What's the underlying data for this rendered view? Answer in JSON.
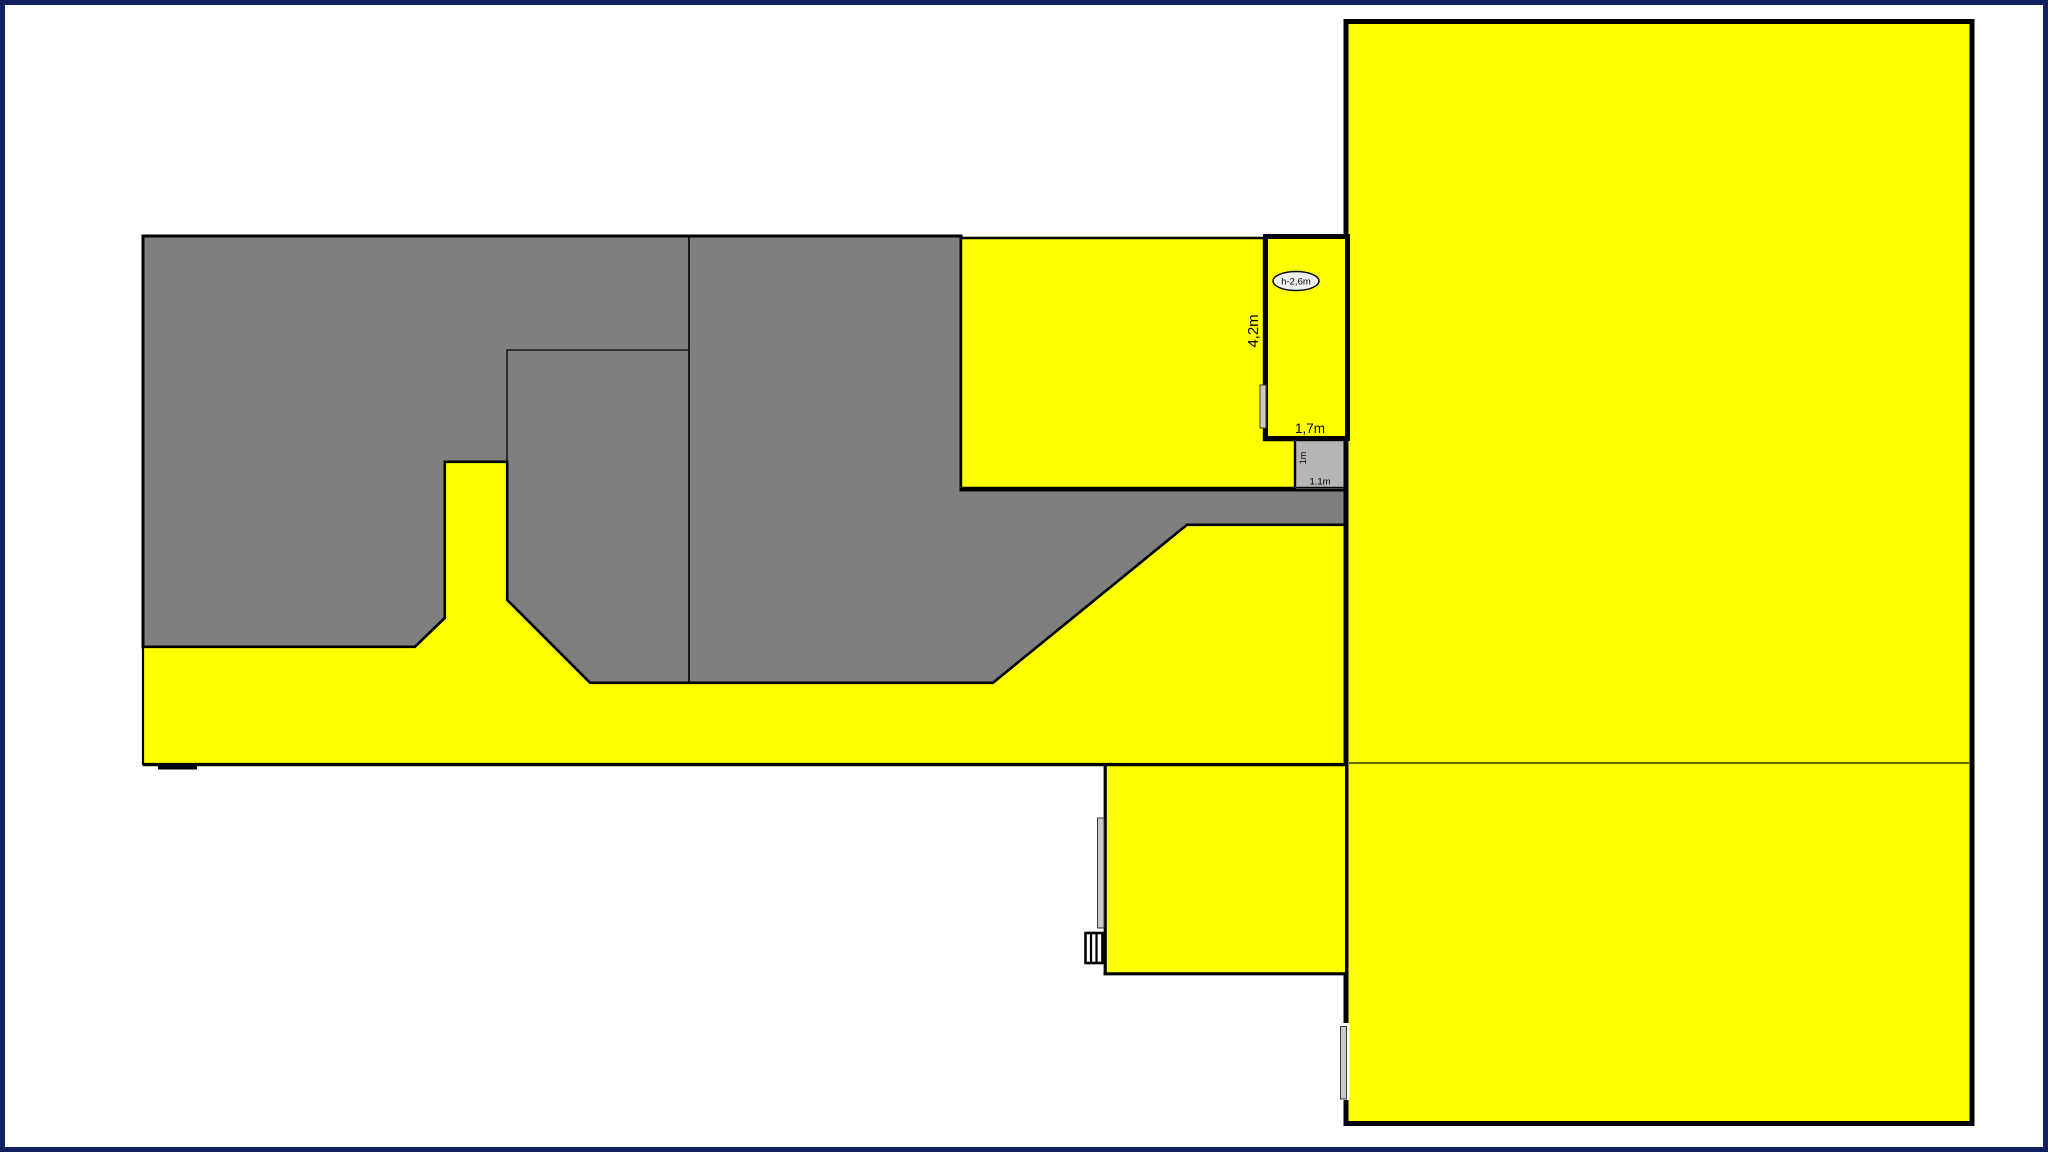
{
  "drawing": {
    "type": "floor-plan",
    "labels": {
      "ceiling_height": "h-2,6m",
      "dim_room_depth": "4,2m",
      "dim_room_width": "1,7m",
      "dim_alcove_depth": "1m",
      "dim_alcove_width": "1.1m"
    },
    "colors": {
      "page_border": "#13205f",
      "room_gray": "#7f7f7f",
      "zone_yellow": "#ffff00",
      "alcove_silver": "#b5b5b5",
      "window_silver": "#c9c9c9",
      "line_black": "#000000",
      "ellipse_fill": "#f0f0f0",
      "background": "#ffffff"
    }
  }
}
